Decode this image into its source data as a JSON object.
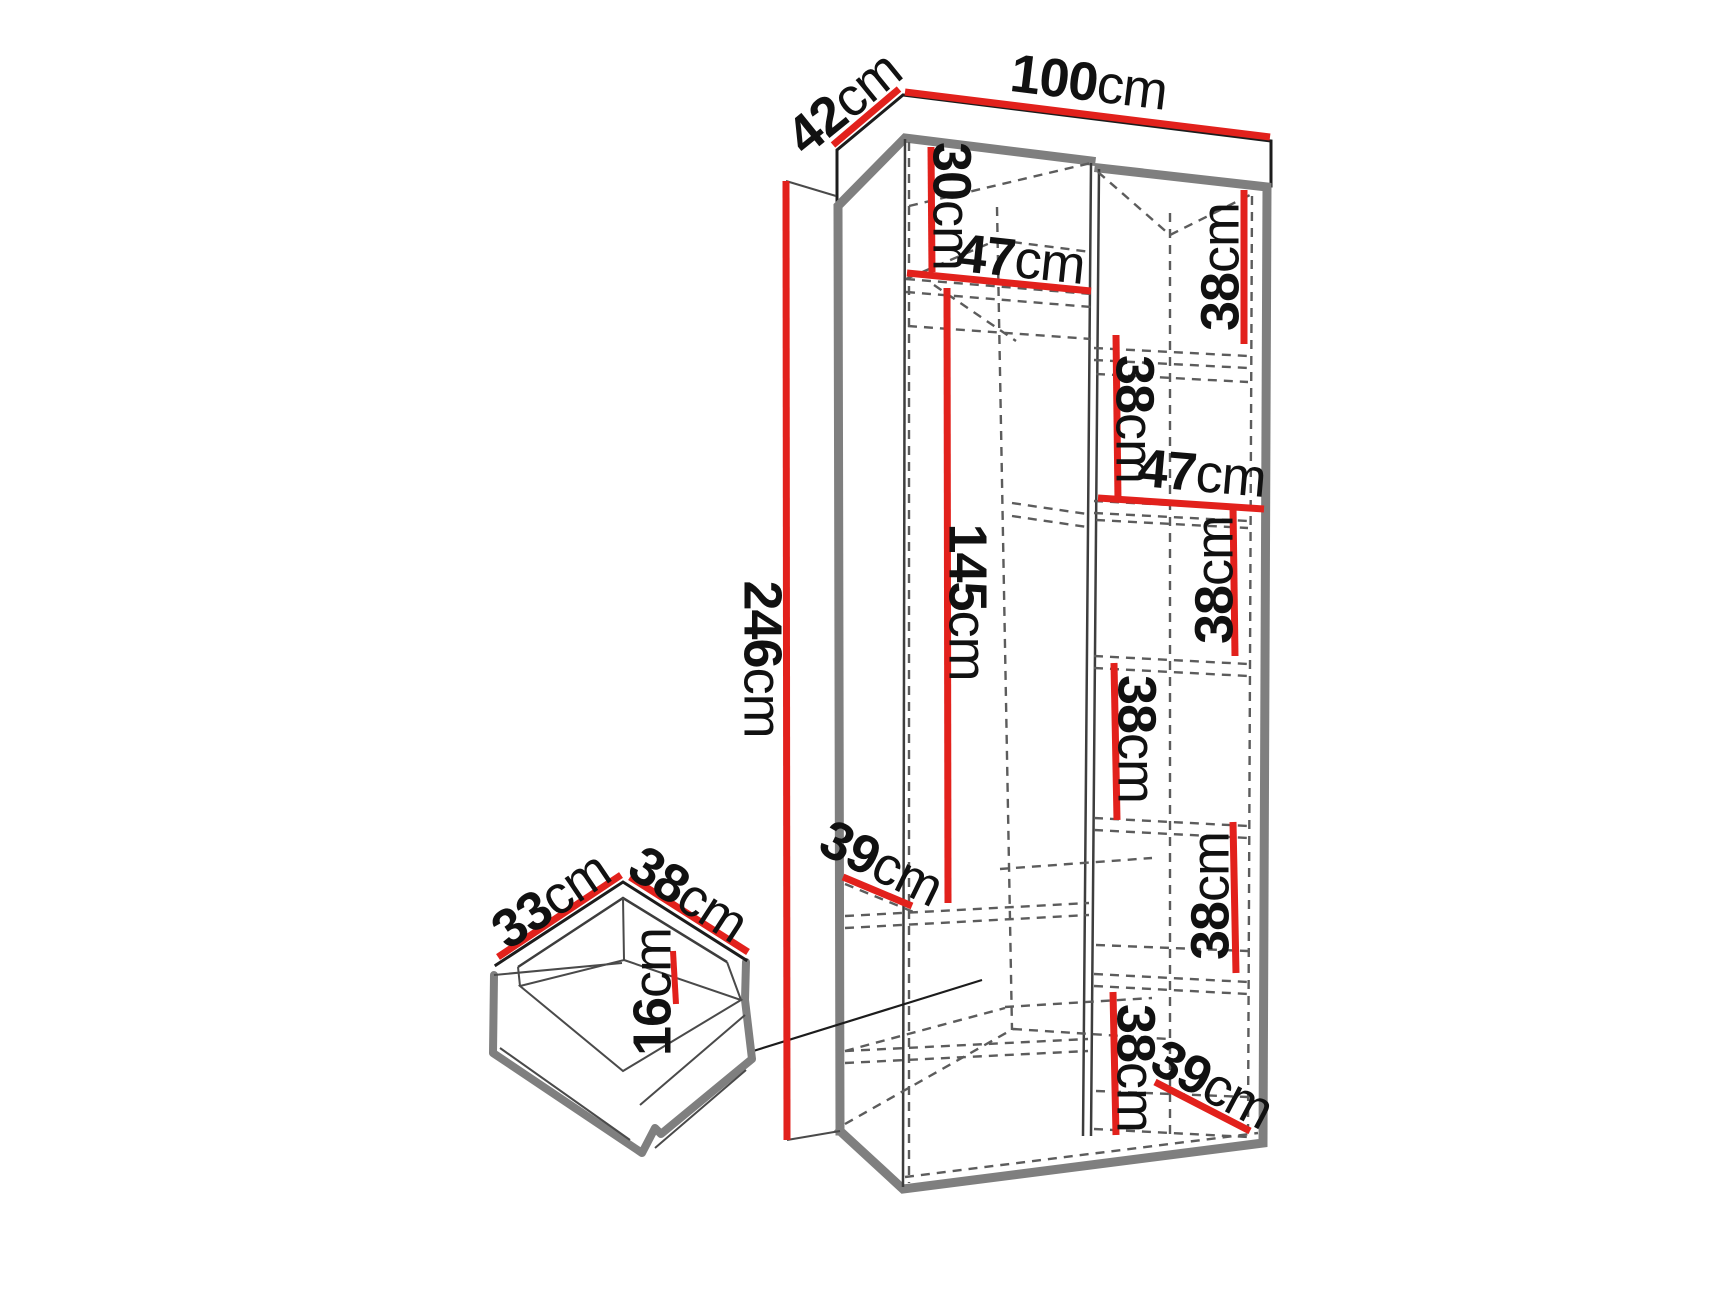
{
  "diagram_title": "wardrobe-dimension-diagram",
  "unit": "cm",
  "colors": {
    "accent": "#e2211c",
    "frame": "#7f7f7f",
    "line": "#1c1c1c",
    "dash": "#5c5c5c",
    "text": "#111111",
    "background": "#ffffff"
  },
  "labels": {
    "depth_top": {
      "num": "42",
      "unit": "cm"
    },
    "width_top": {
      "num": "100",
      "unit": "cm"
    },
    "upper_height": {
      "num": "30",
      "unit": "cm"
    },
    "upper_width": {
      "num": "47",
      "unit": "cm"
    },
    "cubby1_height": {
      "num": "38",
      "unit": "cm"
    },
    "cubby2_height": {
      "num": "38",
      "unit": "cm"
    },
    "mid_width": {
      "num": "47",
      "unit": "cm"
    },
    "cubby3_height": {
      "num": "38",
      "unit": "cm"
    },
    "cubby4_height": {
      "num": "38",
      "unit": "cm"
    },
    "cubby5_height": {
      "num": "38",
      "unit": "cm"
    },
    "cubby6_height": {
      "num": "38",
      "unit": "cm"
    },
    "total_height": {
      "num": "246",
      "unit": "cm"
    },
    "hanging_height": {
      "num": "145",
      "unit": "cm"
    },
    "left_shelf_depth": {
      "num": "39",
      "unit": "cm"
    },
    "bottom_depth": {
      "num": "39",
      "unit": "cm"
    },
    "drawer_depth": {
      "num": "33",
      "unit": "cm"
    },
    "drawer_width": {
      "num": "38",
      "unit": "cm"
    },
    "drawer_height": {
      "num": "16",
      "unit": "cm"
    }
  }
}
